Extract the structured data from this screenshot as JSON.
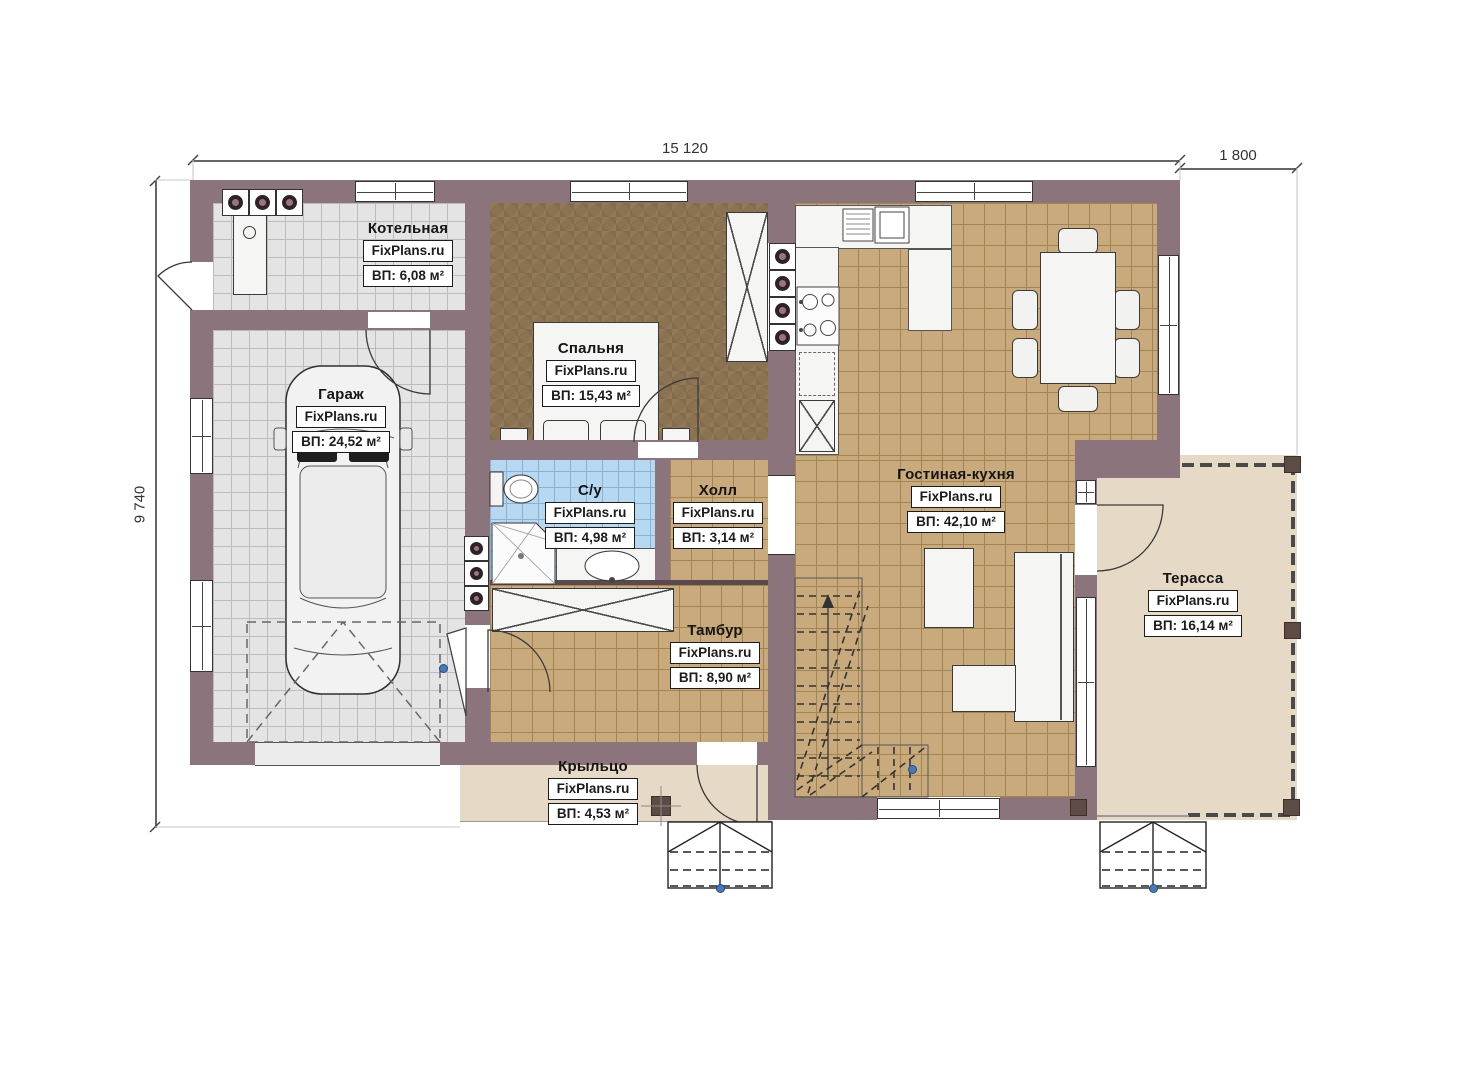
{
  "brand": "FixPlans.ru",
  "dimensions": {
    "top": "15 120",
    "top_right": "1 800",
    "left": "9 740"
  },
  "rooms": [
    {
      "name": "Котельная",
      "watermark": "FixPlans.ru",
      "area": "ВП: 6,08 м²",
      "floor": "gray-tile",
      "furniture": [
        "boiler-unit",
        "vent-stacks"
      ]
    },
    {
      "name": "Гараж",
      "watermark": "FixPlans.ru",
      "area": "ВП: 24,52 м²",
      "floor": "gray-tile",
      "furniture": [
        "car",
        "garage-gate"
      ]
    },
    {
      "name": "Спальня",
      "watermark": "FixPlans.ru",
      "area": "ВП: 15,43 м²",
      "floor": "brown-carpet",
      "furniture": [
        "double-bed",
        "nightstands",
        "wardrobe"
      ]
    },
    {
      "name": "С/у",
      "watermark": "FixPlans.ru",
      "area": "ВП: 4,98 м²",
      "floor": "blue-tile",
      "furniture": [
        "toilet",
        "corner-shower",
        "washbasin"
      ]
    },
    {
      "name": "Холл",
      "watermark": "FixPlans.ru",
      "area": "ВП: 3,14 м²",
      "floor": "tan-tile",
      "furniture": []
    },
    {
      "name": "Тамбур",
      "watermark": "FixPlans.ru",
      "area": "ВП: 8,90 м²",
      "floor": "tan-tile",
      "furniture": [
        "wardrobe-cabinet"
      ]
    },
    {
      "name": "Гостиная-кухня",
      "watermark": "FixPlans.ru",
      "area": "ВП: 42,10 м²",
      "floor": "tan-tile",
      "furniture": [
        "kitchen-counter",
        "sink",
        "stove",
        "fridge",
        "dining-table-6-chairs",
        "sofa",
        "coffee-table",
        "staircase"
      ]
    },
    {
      "name": "Терасса",
      "watermark": "FixPlans.ru",
      "area": "ВП: 16,14 м²",
      "floor": "beige",
      "furniture": [
        "railing",
        "posts",
        "entry-steps"
      ]
    },
    {
      "name": "Крыльцо",
      "watermark": "FixPlans.ru",
      "area": "ВП: 4,53 м²",
      "floor": "beige",
      "furniture": [
        "post",
        "entry-steps"
      ]
    }
  ],
  "colors": {
    "wall": "#8b747c",
    "tan_tile": "#c9aa7d",
    "gray_tile": "#e4e4e4",
    "blue_tile": "#b7d8f1",
    "bedroom_floor": "#8b7351",
    "terrace_floor": "#e6dac7",
    "handle_dot": "#4a7ab5"
  }
}
